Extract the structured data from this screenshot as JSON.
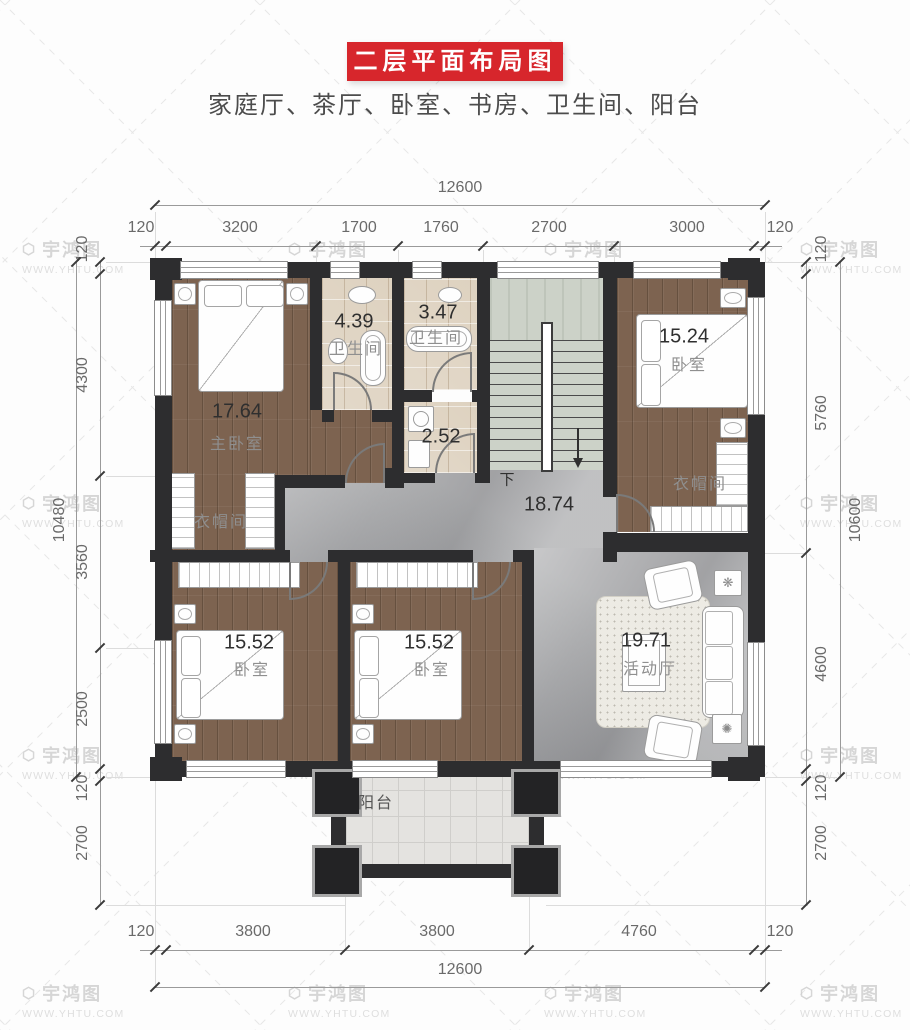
{
  "header": {
    "title": "二层平面布局图",
    "subtitle": "家庭厅、茶厅、卧室、书房、卫生间、阳台",
    "banner_color": "#d7262c"
  },
  "watermark": {
    "logo": "宇鸿图",
    "url": "WWW.YHTU.COM",
    "hex_icon": "⬡"
  },
  "dimensions": {
    "top": {
      "total": "12600",
      "segments": [
        "120",
        "3200",
        "1700",
        "1760",
        "2700",
        "3000",
        "120"
      ]
    },
    "bottom": {
      "total": "12600",
      "segments": [
        "120",
        "3800",
        "3800",
        "4760",
        "120"
      ]
    },
    "left": {
      "total": "10480",
      "segments": [
        "120",
        "4300",
        "3560",
        "2500",
        "120",
        "2700"
      ]
    },
    "right": {
      "total": "10600",
      "segments": [
        "120",
        "5760",
        "4600",
        "120",
        "2700"
      ]
    }
  },
  "rooms": {
    "master": {
      "area": "17.64",
      "label": "主卧室"
    },
    "master_closet": {
      "label": "衣帽间"
    },
    "bath1": {
      "area": "4.39",
      "label": "卫生间"
    },
    "bath2": {
      "area": "3.47",
      "label": "卫生间"
    },
    "laundry": {
      "area": "2.52"
    },
    "hall": {
      "area": "18.74",
      "stair_direction": "下"
    },
    "bedroom_right": {
      "area": "15.24",
      "label": "卧室"
    },
    "bedroom_right_closet": {
      "label": "衣帽间"
    },
    "bedroom_left": {
      "area": "15.52",
      "label": "卧室"
    },
    "bedroom_mid": {
      "area": "15.52",
      "label": "卧室"
    },
    "family_room": {
      "area": "19.71",
      "label": "活动厅"
    },
    "balcony": {
      "label": "阳台"
    }
  },
  "colors": {
    "wall": "#2d2d2f",
    "wood_floor": "#7d6350",
    "marble_floor": "#a6a7a9",
    "bath_tile": "#ded2c0",
    "stair_stone": "#ccd2c8",
    "balcony_tile": "#e4e3e0"
  }
}
